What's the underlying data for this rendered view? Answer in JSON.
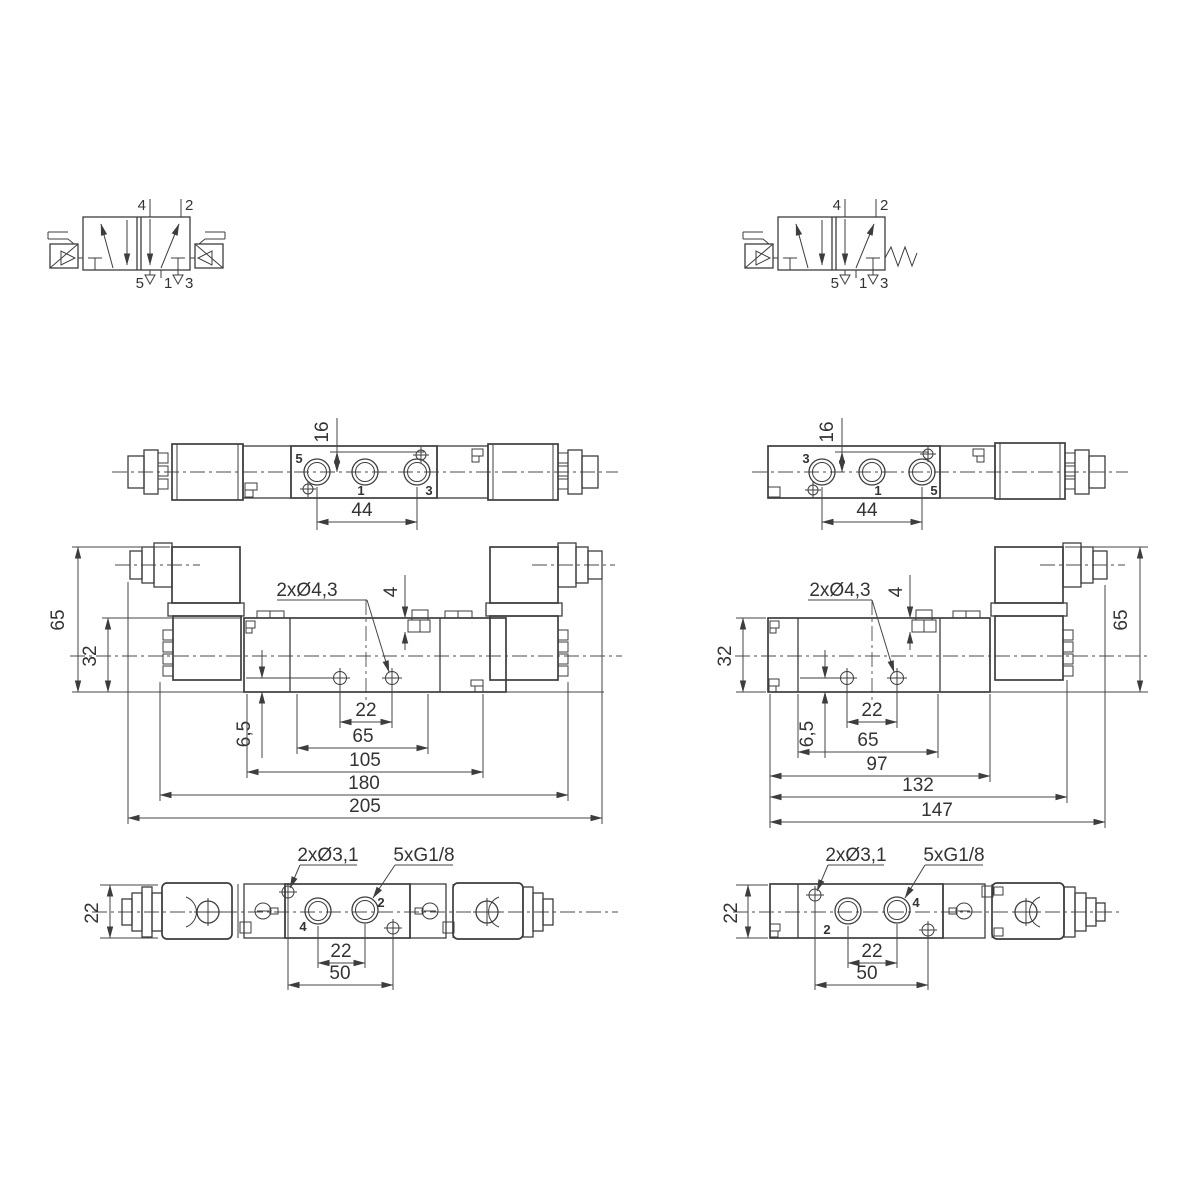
{
  "title": "5/2 solenoid valve dimensional drawing",
  "left_valve": {
    "symbol": {
      "ports_top": [
        "4",
        "2"
      ],
      "ports_bottom": [
        "5",
        "1",
        "3"
      ]
    },
    "top_view": {
      "port_labels": [
        "5",
        "1",
        "3"
      ],
      "dim_height": "16",
      "dim_port_span": "44"
    },
    "front_view": {
      "dim_total_height": "65",
      "dim_body_height": "32",
      "hole_note": "2xØ4,3",
      "dim_step": "4",
      "dim_hole_offset": "6,5",
      "dim_hole_spacing": "22",
      "dim_ports_block": "65",
      "dim_clamp_span": "105",
      "dim_coil_span": "180",
      "dim_overall": "205"
    },
    "bottom_view": {
      "dim_height": "22",
      "hole_note": "2xØ3,1",
      "thread_note": "5xG1/8",
      "port_labels": [
        "4",
        "2"
      ],
      "dim_port_spacing": "22",
      "dim_hole_spacing": "50"
    }
  },
  "right_valve": {
    "symbol": {
      "ports_top": [
        "4",
        "2"
      ],
      "ports_bottom": [
        "5",
        "1",
        "3"
      ]
    },
    "top_view": {
      "port_labels": [
        "3",
        "1",
        "5"
      ],
      "dim_height": "16",
      "dim_port_span": "44"
    },
    "front_view": {
      "dim_total_height": "65",
      "dim_body_height": "32",
      "hole_note": "2xØ4,3",
      "dim_step": "4",
      "dim_hole_offset": "6,5",
      "dim_hole_spacing": "22",
      "dim_ports_block": "65",
      "dim_body_span": "97",
      "dim_coil_span": "132",
      "dim_overall": "147"
    },
    "bottom_view": {
      "dim_height": "22",
      "hole_note": "2xØ3,1",
      "thread_note": "5xG1/8",
      "port_labels": [
        "2",
        "4"
      ],
      "dim_port_spacing": "22",
      "dim_hole_spacing": "50"
    }
  }
}
